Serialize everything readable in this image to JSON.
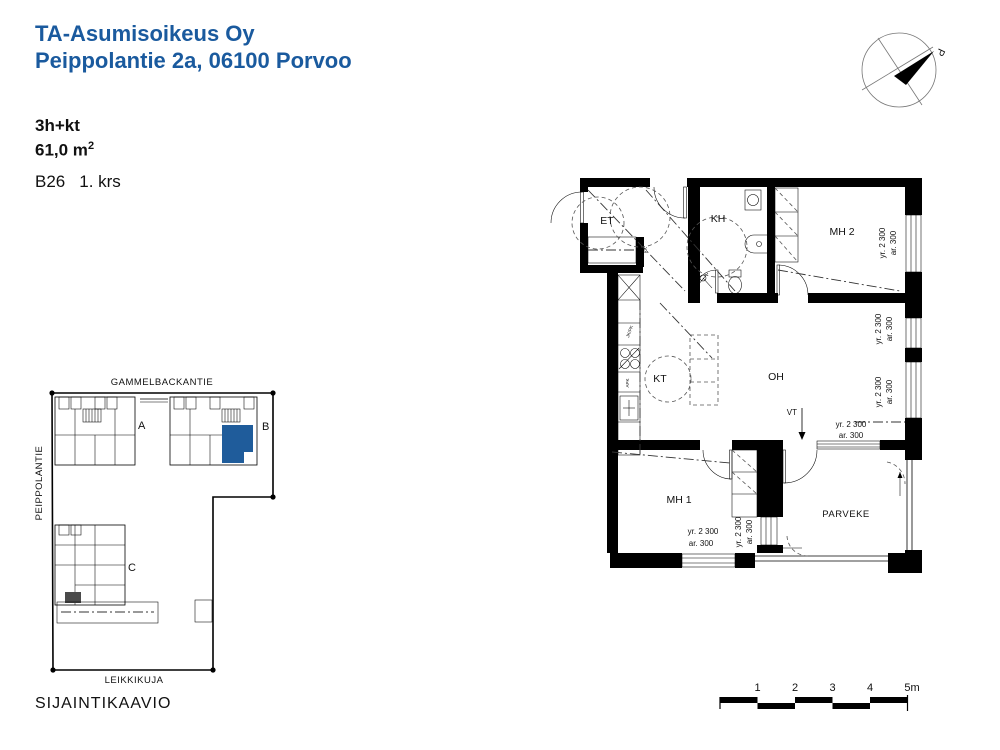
{
  "header": {
    "company": "TA-Asumisoikeus Oy",
    "address": "Peippolantie 2a, 06100 Porvoo"
  },
  "apartment": {
    "type": "3h+kt",
    "area": "61,0 m",
    "area_sup": "2",
    "unit": "B26",
    "floor": "1. krs"
  },
  "compass": {
    "north_label": "P"
  },
  "floor_plan": {
    "rooms": {
      "et": "ET",
      "kh": "KH",
      "mh2": "MH 2",
      "kt": "KT",
      "oh": "OH",
      "mh1": "MH 1",
      "parveke": "PARVEKE"
    },
    "dim_yr": "yr. 2 300",
    "dim_ar": "ar. 300",
    "annotations": {
      "vt": "VT",
      "kk": "KK",
      "apk": "APK",
      "jkpk": "JK/PK"
    }
  },
  "site_plan": {
    "title": "SIJAINTIKAAVIO",
    "street_top": "GAMMELBACKANTIE",
    "street_left": "PEIPPOLANTIE",
    "street_bottom": "LEIKKIKUJA",
    "building_a": "A",
    "building_b": "B",
    "building_c": "C"
  },
  "scale_bar": {
    "labels": [
      "1",
      "2",
      "3",
      "4",
      "5m"
    ]
  },
  "colors": {
    "accent": "#1a5a9e",
    "highlight": "#1f5c9b"
  }
}
